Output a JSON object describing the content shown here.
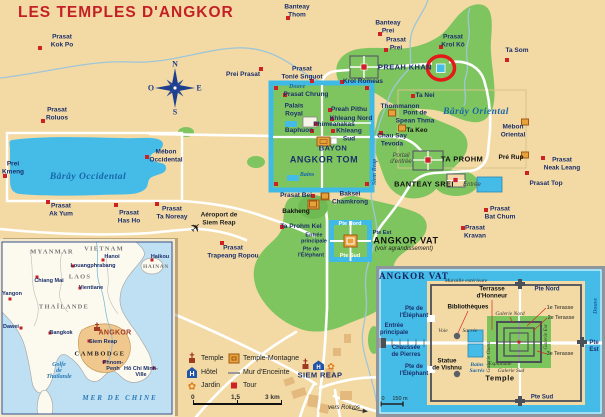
{
  "title": "LES TEMPLES D'ANGKOR",
  "colors": {
    "background": "#F3DAA4",
    "forest": "#7FC55F",
    "water": "#45BCE8",
    "road": "#FFFFFF",
    "marker_red": "#CE2126",
    "temple_orange": "#E8A23C",
    "title_red": "#C32026",
    "label_navy": "#1B2F6B"
  },
  "legend": {
    "temple": "Temple",
    "hotel": "Hôtel",
    "jardin": "Jardin",
    "temple_montagne": "Temple-Montagne",
    "mur": "Mur d'Enceinte",
    "tour": "Tour"
  },
  "scale_bar": {
    "start": "0",
    "mid": "1,5",
    "end": "3 km"
  },
  "main_map": {
    "labels": [
      {
        "t": "Prasat\nKok Po",
        "x": 62,
        "y": 41,
        "c": ""
      },
      {
        "t": "Prasat\nRoluos",
        "x": 57,
        "y": 114,
        "c": ""
      },
      {
        "t": "Banteay\nThom",
        "x": 297,
        "y": 11,
        "c": ""
      },
      {
        "t": "Banteay\nPrei",
        "x": 388,
        "y": 27,
        "c": ""
      },
      {
        "t": "Prasat\nPrei",
        "x": 396,
        "y": 44,
        "c": ""
      },
      {
        "t": "Prei Prasat",
        "x": 243,
        "y": 75,
        "c": ""
      },
      {
        "t": "Prasat\nTonlé Snguot",
        "x": 302,
        "y": 73,
        "c": ""
      },
      {
        "t": "Krol Romeas",
        "x": 363,
        "y": 82,
        "c": ""
      },
      {
        "t": "Prasat\nKrol Kô",
        "x": 453,
        "y": 41,
        "c": ""
      },
      {
        "t": "Ta Som",
        "x": 517,
        "y": 51,
        "c": ""
      },
      {
        "t": "PREAH KHAN",
        "x": 405,
        "y": 68,
        "c": "caps"
      },
      {
        "t": "Ta Nei",
        "x": 425,
        "y": 96,
        "c": ""
      },
      {
        "t": "Thommanon",
        "x": 400,
        "y": 107,
        "c": ""
      },
      {
        "t": "Pont de\nSpean Thma",
        "x": 415,
        "y": 117,
        "c": ""
      },
      {
        "t": "Ta Keo",
        "x": 417,
        "y": 131,
        "c": "black"
      },
      {
        "t": "Chau Say\nTevoda",
        "x": 392,
        "y": 140,
        "c": ""
      },
      {
        "t": "Bârây Oriental",
        "x": 476,
        "y": 112,
        "c": "water water-big"
      },
      {
        "t": "Mébon\nOriental",
        "x": 513,
        "y": 131,
        "c": ""
      },
      {
        "t": "Pré Rup",
        "x": 511,
        "y": 158,
        "c": "black"
      },
      {
        "t": "Prasat\nNeak Leang",
        "x": 562,
        "y": 164,
        "c": ""
      },
      {
        "t": "Portail\nd'entrée",
        "x": 401,
        "y": 159,
        "c": "grayit"
      },
      {
        "t": "TA PROHM",
        "x": 462,
        "y": 160,
        "c": "black caps"
      },
      {
        "t": "BANTEAY SREI",
        "x": 424,
        "y": 185,
        "c": "black caps"
      },
      {
        "t": "Entrée",
        "x": 472,
        "y": 185,
        "c": "grayit"
      },
      {
        "t": "Prasat Top",
        "x": 546,
        "y": 184,
        "c": ""
      },
      {
        "t": "Prasat\nBat Chum",
        "x": 500,
        "y": 213,
        "c": ""
      },
      {
        "t": "Prasat\nKravan",
        "x": 475,
        "y": 232,
        "c": ""
      },
      {
        "t": "Prasat\nAk Yum",
        "x": 61,
        "y": 210,
        "c": ""
      },
      {
        "t": "Prasat\nHas Ho",
        "x": 129,
        "y": 217,
        "c": ""
      },
      {
        "t": "Prasat\nTa Noreay",
        "x": 172,
        "y": 213,
        "c": ""
      },
      {
        "t": "Prei\nKmeng",
        "x": 13,
        "y": 168,
        "c": ""
      },
      {
        "t": "Mébon\nOccidental",
        "x": 166,
        "y": 156,
        "c": ""
      },
      {
        "t": "Bârây Occidental",
        "x": 88,
        "y": 177,
        "c": "water water-big"
      },
      {
        "t": "Prasat Chrung",
        "x": 306,
        "y": 95,
        "c": ""
      },
      {
        "t": "Palais\nRoyal",
        "x": 294,
        "y": 110,
        "c": ""
      },
      {
        "t": "Preah Pithu",
        "x": 349,
        "y": 110,
        "c": ""
      },
      {
        "t": "Khleang Nord",
        "x": 351,
        "y": 119,
        "c": ""
      },
      {
        "t": "Phimeanakas",
        "x": 334,
        "y": 125,
        "c": ""
      },
      {
        "t": "Baphuon",
        "x": 299,
        "y": 131,
        "c": ""
      },
      {
        "t": "Khleang\nSud",
        "x": 349,
        "y": 135,
        "c": ""
      },
      {
        "t": "BAYON",
        "x": 333,
        "y": 149,
        "c": "caps"
      },
      {
        "t": "ANGKOR TOM",
        "x": 324,
        "y": 160,
        "c": "caps lg"
      },
      {
        "t": "Douve",
        "x": 297,
        "y": 87,
        "c": "water sm"
      },
      {
        "t": "Bains",
        "x": 307,
        "y": 175,
        "c": "water sm"
      },
      {
        "t": "Prasat Bei",
        "x": 296,
        "y": 196,
        "c": ""
      },
      {
        "t": "Baksei\nChamkrong",
        "x": 350,
        "y": 198,
        "c": ""
      },
      {
        "t": "Bakheng",
        "x": 296,
        "y": 212,
        "c": "black"
      },
      {
        "t": "Ta Prohm Kel",
        "x": 301,
        "y": 227,
        "c": ""
      },
      {
        "t": "Aéroport de\nSiem Reap",
        "x": 219,
        "y": 219,
        "c": "airport"
      },
      {
        "t": "Prasat\nTrapeang Ropou",
        "x": 233,
        "y": 252,
        "c": ""
      },
      {
        "t": "Pte Nord",
        "x": 350,
        "y": 224,
        "c": "white"
      },
      {
        "t": "Pte Est",
        "x": 382,
        "y": 233,
        "c": "tiny"
      },
      {
        "t": "Pte Sud",
        "x": 350,
        "y": 256,
        "c": "white"
      },
      {
        "t": "Entrée\nprincipale",
        "x": 314,
        "y": 239,
        "c": "tiny"
      },
      {
        "t": "Pte de\nl'Éléphant",
        "x": 311,
        "y": 253,
        "c": "tiny"
      },
      {
        "t": "ANGKOR VAT",
        "x": 406,
        "y": 241,
        "c": "black caps lg"
      },
      {
        "t": "(voir agrandissement)",
        "x": 404,
        "y": 249,
        "c": "itsm"
      },
      {
        "t": "Siem Reap",
        "x": 375,
        "y": 172,
        "c": "water sm vert"
      },
      {
        "t": "SIEM REAP",
        "x": 320,
        "y": 376,
        "c": "caps"
      },
      {
        "t": "vers Roluos",
        "x": 344,
        "y": 408,
        "c": "itsm"
      },
      {
        "t": "N",
        "x": 175,
        "y": 64,
        "c": "compass"
      },
      {
        "t": "S",
        "x": 175,
        "y": 112,
        "c": "compass"
      },
      {
        "t": "E",
        "x": 199,
        "y": 88,
        "c": "compass"
      },
      {
        "t": "O",
        "x": 151,
        "y": 88,
        "c": "compass"
      }
    ],
    "markers": [
      {
        "x": 40,
        "y": 48,
        "k": "r"
      },
      {
        "x": 43,
        "y": 121,
        "k": "r"
      },
      {
        "x": 288,
        "y": 18,
        "k": "r"
      },
      {
        "x": 380,
        "y": 34,
        "k": "r"
      },
      {
        "x": 386,
        "y": 50,
        "k": "r"
      },
      {
        "x": 261,
        "y": 69,
        "k": "r"
      },
      {
        "x": 312,
        "y": 81,
        "k": "r"
      },
      {
        "x": 342,
        "y": 82,
        "k": "r"
      },
      {
        "x": 441,
        "y": 47,
        "k": "r"
      },
      {
        "x": 507,
        "y": 60,
        "k": "r"
      },
      {
        "x": 413,
        "y": 96,
        "k": "r"
      },
      {
        "x": 381,
        "y": 133,
        "k": "r"
      },
      {
        "x": 543,
        "y": 158,
        "k": "r"
      },
      {
        "x": 527,
        "y": 173,
        "k": "r"
      },
      {
        "x": 486,
        "y": 210,
        "k": "r"
      },
      {
        "x": 463,
        "y": 228,
        "k": "r"
      },
      {
        "x": 48,
        "y": 202,
        "k": "r"
      },
      {
        "x": 116,
        "y": 205,
        "k": "r"
      },
      {
        "x": 157,
        "y": 204,
        "k": "r"
      },
      {
        "x": 5,
        "y": 176,
        "k": "r"
      },
      {
        "x": 147,
        "y": 157,
        "k": "r"
      },
      {
        "x": 285,
        "y": 95,
        "k": "r"
      },
      {
        "x": 330,
        "y": 110,
        "k": "r"
      },
      {
        "x": 332,
        "y": 119,
        "k": "r"
      },
      {
        "x": 316,
        "y": 124,
        "k": "r"
      },
      {
        "x": 312,
        "y": 131,
        "k": "r"
      },
      {
        "x": 333,
        "y": 131,
        "k": "r"
      },
      {
        "x": 313,
        "y": 196,
        "k": "r"
      },
      {
        "x": 282,
        "y": 227,
        "k": "r"
      },
      {
        "x": 222,
        "y": 243,
        "k": "r"
      },
      {
        "x": 276,
        "y": 88,
        "k": "r"
      },
      {
        "x": 367,
        "y": 88,
        "k": "r"
      },
      {
        "x": 276,
        "y": 184,
        "k": "r"
      },
      {
        "x": 367,
        "y": 184,
        "k": "r"
      },
      {
        "x": 392,
        "y": 113,
        "k": "tm"
      },
      {
        "x": 402,
        "y": 128,
        "k": "tm"
      },
      {
        "x": 525,
        "y": 122,
        "k": "tm"
      },
      {
        "x": 525,
        "y": 155,
        "k": "tm"
      },
      {
        "x": 313,
        "y": 204,
        "k": "tm"
      },
      {
        "x": 325,
        "y": 196,
        "k": "tm"
      }
    ]
  },
  "inset_sea": {
    "labels": [
      {
        "t": "MYANMAR",
        "x": 52,
        "y": 252,
        "c": "country"
      },
      {
        "t": "VIETNAM",
        "x": 104,
        "y": 249,
        "c": "country"
      },
      {
        "t": "Hanoi",
        "x": 112,
        "y": 257,
        "c": "city"
      },
      {
        "t": "Haikou",
        "x": 160,
        "y": 257,
        "c": "city"
      },
      {
        "t": "HAINAN",
        "x": 156,
        "y": 267,
        "c": "country sm"
      },
      {
        "t": "Louangphrabang",
        "x": 93,
        "y": 266,
        "c": "city"
      },
      {
        "t": "LAOS",
        "x": 80,
        "y": 277,
        "c": "country"
      },
      {
        "t": "Chiang Mai",
        "x": 49,
        "y": 281,
        "c": "city"
      },
      {
        "t": "Vientiane",
        "x": 91,
        "y": 288,
        "c": "city"
      },
      {
        "t": "Yangon",
        "x": 12,
        "y": 294,
        "c": "city"
      },
      {
        "t": "THAÏLANDE",
        "x": 64,
        "y": 307,
        "c": "country"
      },
      {
        "t": "Dawei",
        "x": 11,
        "y": 327,
        "c": "city"
      },
      {
        "t": "Bangkok",
        "x": 61,
        "y": 333,
        "c": "city"
      },
      {
        "t": "ANGKOR",
        "x": 115,
        "y": 333,
        "c": "angkor"
      },
      {
        "t": "Siem Reap",
        "x": 103,
        "y": 342,
        "c": "city"
      },
      {
        "t": "CAMBODGE",
        "x": 100,
        "y": 354,
        "c": "country dark"
      },
      {
        "t": "Golfe\nde\nThaïlande",
        "x": 59,
        "y": 371,
        "c": "sealbl"
      },
      {
        "t": "Phnom-\nPenh",
        "x": 113,
        "y": 366,
        "c": "city"
      },
      {
        "t": "Hô Chi Minh-\nVille",
        "x": 141,
        "y": 372,
        "c": "city"
      },
      {
        "t": "MER DE CHINE",
        "x": 120,
        "y": 398,
        "c": "sealbl caps"
      }
    ],
    "markers": [
      {
        "x": 103,
        "y": 260,
        "k": "city"
      },
      {
        "x": 152,
        "y": 260,
        "k": "city"
      },
      {
        "x": 73,
        "y": 266,
        "k": "city"
      },
      {
        "x": 37,
        "y": 277,
        "k": "city"
      },
      {
        "x": 80,
        "y": 288,
        "k": "city"
      },
      {
        "x": 10,
        "y": 299,
        "k": "city"
      },
      {
        "x": 21,
        "y": 328,
        "k": "city"
      },
      {
        "x": 50,
        "y": 333,
        "k": "city"
      },
      {
        "x": 89,
        "y": 341,
        "k": "city"
      },
      {
        "x": 104,
        "y": 362,
        "k": "city"
      },
      {
        "x": 154,
        "y": 368,
        "k": "city"
      }
    ]
  },
  "inset_vat": {
    "labels": [
      {
        "t": "ANGKOR VAT",
        "x": 414,
        "y": 276,
        "c": "vtitle"
      },
      {
        "t": "Muraille extérieure",
        "x": 466,
        "y": 281,
        "c": "vit"
      },
      {
        "t": "Pte Nord",
        "x": 547,
        "y": 290,
        "c": "vnavy"
      },
      {
        "t": "Terrasse\nd'Honneur",
        "x": 492,
        "y": 293,
        "c": "vblack"
      },
      {
        "t": "Bibliothèques",
        "x": 468,
        "y": 307,
        "c": "vblack"
      },
      {
        "t": "1e Terasse",
        "x": 560,
        "y": 308,
        "c": "vsm"
      },
      {
        "t": "2e Terasse",
        "x": 561,
        "y": 318,
        "c": "vsm"
      },
      {
        "t": "Galerie Nord",
        "x": 510,
        "y": 314,
        "c": "vgal"
      },
      {
        "t": "Douve",
        "x": 596,
        "y": 306,
        "c": "vdouve vert"
      },
      {
        "t": "Pte de\nl'Éléphant",
        "x": 414,
        "y": 313,
        "c": "vnavy"
      },
      {
        "t": "Entrée\nprincipale",
        "x": 394,
        "y": 330,
        "c": "vnavy"
      },
      {
        "t": "Voie",
        "x": 443,
        "y": 331,
        "c": "vit"
      },
      {
        "t": "Sacrée",
        "x": 470,
        "y": 331,
        "c": "vit"
      },
      {
        "t": "Chaussée\nde Pierres",
        "x": 406,
        "y": 352,
        "c": "vnavy"
      },
      {
        "t": "Statue\nde Vishnu",
        "x": 447,
        "y": 365,
        "c": "vblack"
      },
      {
        "t": "Pte de\nl'Éléphant",
        "x": 414,
        "y": 371,
        "c": "vnavy"
      },
      {
        "t": "Bains\nSacrés",
        "x": 477,
        "y": 368,
        "c": "vbains"
      },
      {
        "t": "Galerie Ouest",
        "x": 489,
        "y": 357,
        "c": "vgal vert"
      },
      {
        "t": "Galerie Est",
        "x": 546,
        "y": 337,
        "c": "vgal vert"
      },
      {
        "t": "Esplanade",
        "x": 500,
        "y": 364,
        "c": "vgal"
      },
      {
        "t": "Galerie Sud",
        "x": 511,
        "y": 371,
        "c": "vgal"
      },
      {
        "t": "Temple",
        "x": 500,
        "y": 379,
        "c": "vblack lg"
      },
      {
        "t": "3e Terasse",
        "x": 560,
        "y": 354,
        "c": "vsm"
      },
      {
        "t": "Pte Est",
        "x": 594,
        "y": 347,
        "c": "vnavy"
      },
      {
        "t": "Pte Sud",
        "x": 542,
        "y": 398,
        "c": "vnavy"
      },
      {
        "t": "0",
        "x": 383,
        "y": 399,
        "c": "vsm"
      },
      {
        "t": "150 m",
        "x": 400,
        "y": 399,
        "c": "vsm"
      }
    ]
  }
}
